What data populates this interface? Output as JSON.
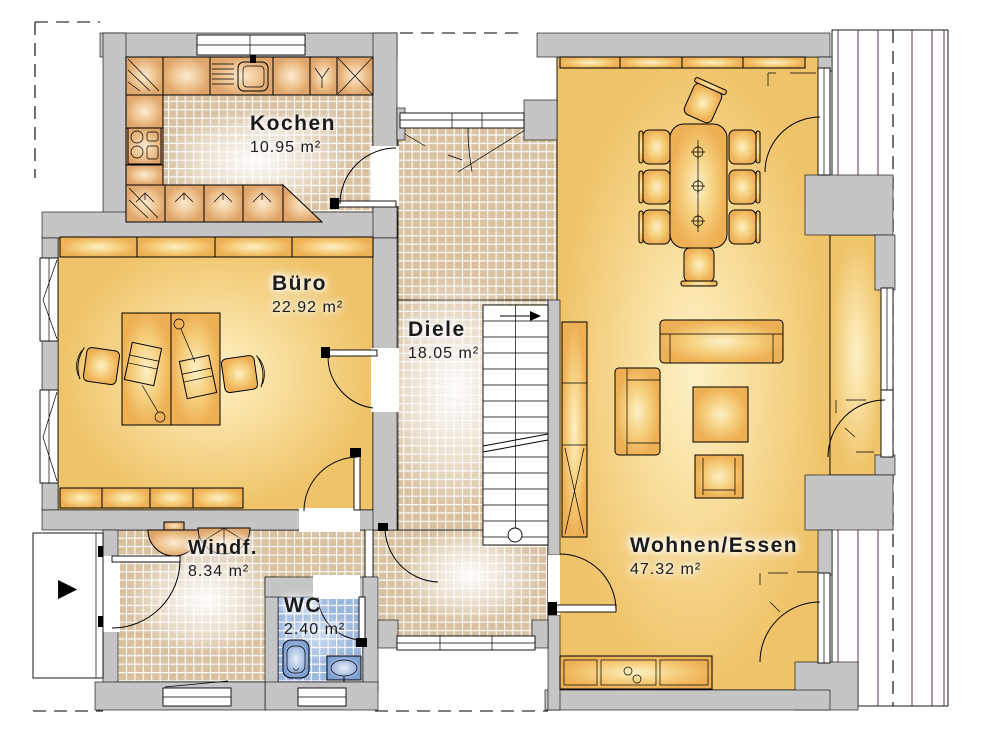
{
  "plan": {
    "rooms": [
      {
        "id": "kochen",
        "name": "Kochen",
        "area": "10.95 m²"
      },
      {
        "id": "buero",
        "name": "Büro",
        "area": "22.92 m²"
      },
      {
        "id": "diele",
        "name": "Diele",
        "area": "18.05 m²"
      },
      {
        "id": "wohnen_essen",
        "name": "Wohnen/Essen",
        "area": "47.32 m²"
      },
      {
        "id": "windfang",
        "name": "Windf.",
        "area": "8.34 m²"
      },
      {
        "id": "wc",
        "name": "WC",
        "area": "2.40 m²"
      }
    ],
    "icons": {
      "entrance_arrow": "▶"
    },
    "colors": {
      "wall": "#c5c5c5",
      "room_floor": "#f6d78c",
      "tile_floor": "#d9c2a2",
      "wc_tile": "#9db8de",
      "furniture": "#f3c267",
      "counter": "#eec08c",
      "wc_fixture": "#a9c0e4",
      "terrace_line": "#5e3355",
      "outline": "#000000"
    }
  }
}
